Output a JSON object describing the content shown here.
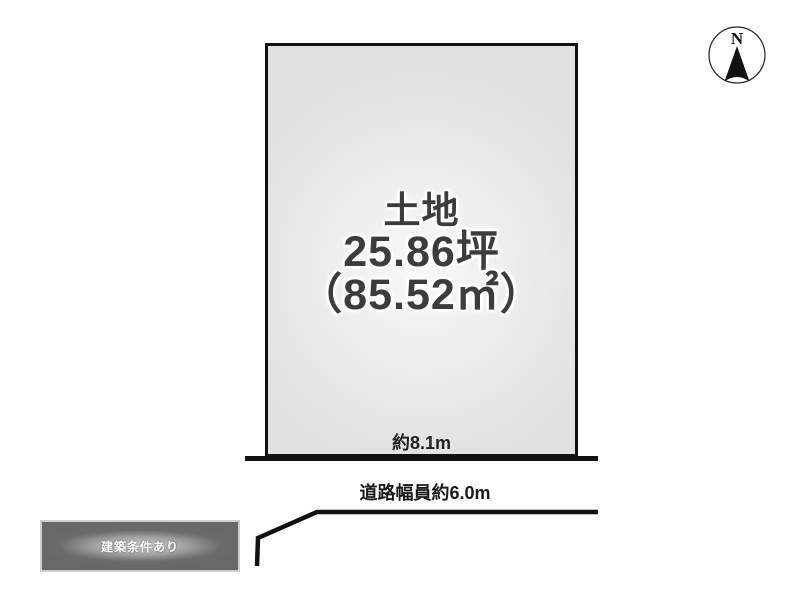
{
  "meta": {
    "description": "real-estate land layout diagram"
  },
  "compass": {
    "label": "N"
  },
  "plot": {
    "title": "土地",
    "area_tsubo": "25.86坪",
    "area_sqm": "（85.52㎡）",
    "frontage": "約8.1m"
  },
  "road": {
    "label": "道路幅員約6.0m"
  },
  "badge": {
    "label": "建築条件あり"
  },
  "colors": {
    "background": "#ffffff",
    "line": "#111111",
    "plot_fill_edge": "#e1e1e1",
    "plot_fill_center": "#f8f8f8",
    "plot_text": "#3c3c3c",
    "badge_dark": "#6b6b6b",
    "badge_light": "#d4d4d4",
    "badge_text": "#ffffff"
  }
}
